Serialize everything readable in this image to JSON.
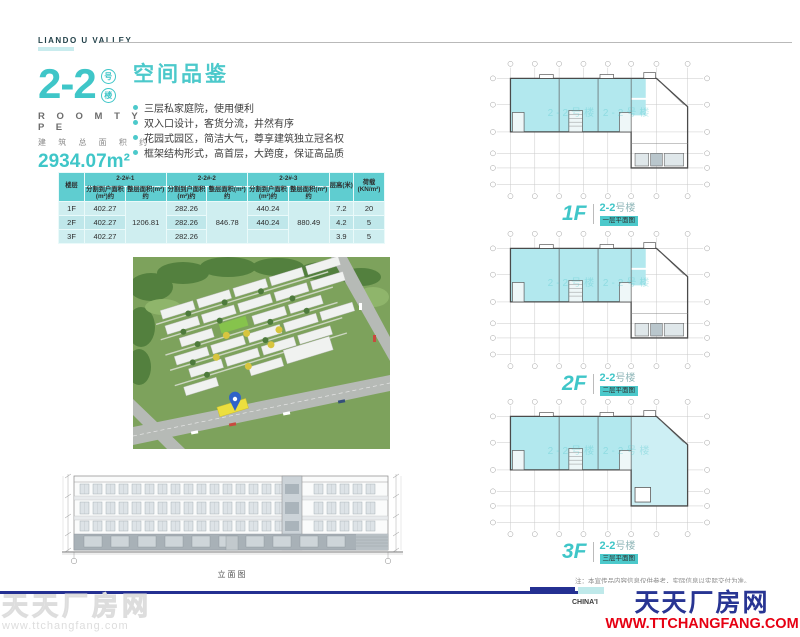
{
  "brand": {
    "name": "LIANDO U VALLEY"
  },
  "unit": {
    "number": "2-2",
    "badge_chars": [
      "号",
      "楼"
    ],
    "room_type": "R O O M   T Y P E",
    "area_label": "建 筑 总 面 积 约",
    "area_value": "2934.07m²"
  },
  "highlights": {
    "title": "空间品鉴",
    "items": [
      "三层私家庭院，使用便利",
      "双入口设计，客货分流，井然有序",
      "花园式园区，简洁大气，尊享建筑独立冠名权",
      "框架结构形式，高首层，大跨度，保证高品质"
    ]
  },
  "spec_table": {
    "floor_header": "楼层",
    "unit_groups": [
      "2-2#-1",
      "2-2#-2",
      "2-2#-3"
    ],
    "split_header": "分割到户面积(m²)约",
    "whole_header": "整层面积(m²)约",
    "height_header": "层高(米)",
    "load_header": "荷载(KN/m²)",
    "rows": [
      {
        "floor": "1F",
        "split1": "402.27",
        "split2": "282.26",
        "split3": "440.24",
        "height": "7.2",
        "load": "20"
      },
      {
        "floor": "2F",
        "split1": "402.27",
        "split2": "282.26",
        "split3": "440.24",
        "height": "4.2",
        "load": "5"
      },
      {
        "floor": "3F",
        "split1": "402.27",
        "split2": "282.26",
        "split3": "",
        "height": "3.9",
        "load": "5"
      }
    ],
    "whole_floor": {
      "unit1": "1206.81",
      "unit2": "846.78",
      "unit3": "880.49"
    }
  },
  "elevation": {
    "caption": "立面图"
  },
  "plans": [
    {
      "floor": "1F",
      "num": "2-2",
      "suffix": "号楼",
      "caption": "一层平面图"
    },
    {
      "floor": "2F",
      "num": "2-2",
      "suffix": "号楼",
      "caption": "二层平面图"
    },
    {
      "floor": "3F",
      "num": "2-2",
      "suffix": "号楼",
      "caption": "三层平面图"
    }
  ],
  "plan_watermark": "2-2号楼  2-2号楼",
  "note": "注：本宣传品内容信息仅供参考，实际信息以实际交付为准。",
  "footer": {
    "partial_text": "CHINA'I",
    "site_name": "天天厂房网",
    "site_url": "WWW.TTCHANGFANG.COM",
    "watermark_name": "天天厂房网",
    "watermark_url": "www.ttchangfang.com"
  },
  "colors": {
    "accent": "#3fc6c8",
    "navy": "#243092",
    "red": "#e60012",
    "plan_fill": "#b2e8ee"
  }
}
